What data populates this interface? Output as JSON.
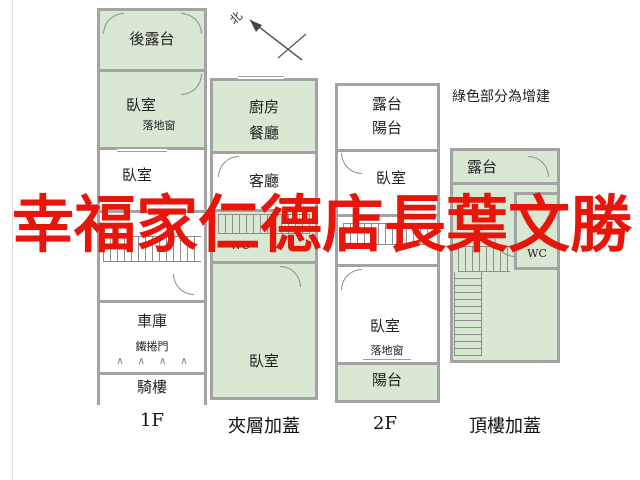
{
  "watermark": {
    "text": "幸福家仁德店長葉文勝",
    "color": "#e8150b"
  },
  "annotation": {
    "note": "綠色部分為增建"
  },
  "compass": {
    "north": "北"
  },
  "colors": {
    "addition_green": "#d9e8d3",
    "wall_gray": "#a3a3a3",
    "watermark_red": "#e8150b"
  },
  "plan1": {
    "label": "1F",
    "rear_terrace": "後露台",
    "bedroom_top": "臥室",
    "floor_window": "落地窗",
    "bedroom_mid": "臥室",
    "garage": "車庫",
    "roller_door": "鐵捲門",
    "roller_icon": "∧∧∧∧",
    "arcade": "騎樓"
  },
  "plan2": {
    "label": "夾層加蓋",
    "kitchen": "廚房",
    "dining": "餐廳",
    "living": "客廳",
    "wc": "WC",
    "bedroom": "臥室"
  },
  "plan3": {
    "label": "2F",
    "terrace": "露台",
    "balcony_top": "陽台",
    "bedroom_top": "臥室",
    "bedroom_bottom": "臥室",
    "floor_window": "落地窗",
    "balcony_bottom": "陽台"
  },
  "plan4": {
    "label": "頂樓加蓋",
    "terrace": "露台",
    "wc": "WC"
  }
}
